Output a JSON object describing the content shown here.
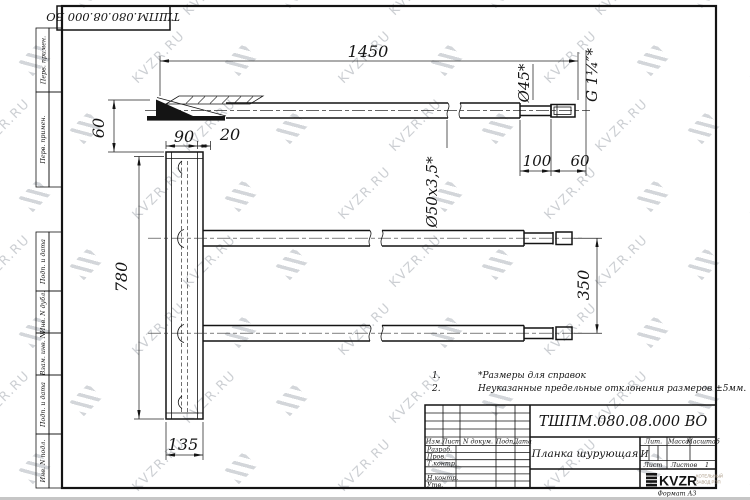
{
  "watermark": {
    "text": "KVZR.RU"
  },
  "top_stamp": {
    "doc_number": "ТШПМ.080.08.000 ВО"
  },
  "margin_labels": [
    "Перв. примен.",
    "Перв. примен.",
    "Подп. и дата",
    "Инв. N дубл.",
    "Взам. инв. N",
    "Подп. и дата",
    "Инв. N подл."
  ],
  "dimensions": {
    "total_length": "1450",
    "left_offset": "60",
    "plate_width": "90",
    "plate_lip": "20",
    "plate_length": "780",
    "tube_spacing": "350",
    "plate_bottom": "135",
    "end_length": "100",
    "thread_length": "60",
    "end_diameter": "Ø45*",
    "tube_section": "Ø50x3,5*",
    "thread": "G 1¼″*"
  },
  "notes": [
    {
      "num": "1.",
      "text": "*Размеры для справок"
    },
    {
      "num": "2.",
      "text": "Неуказанные предельные отклонения размеров ±5мм."
    }
  ],
  "title_block": {
    "doc_number": "ТШПМ.080.08.000 ВО",
    "part_name": "Планка шурующая",
    "header_cells": [
      "Изм.",
      "Лист",
      "N докум.",
      "Подп.",
      "Дата"
    ],
    "signature_rows": [
      "Разраб.",
      "Пров.",
      "Т.контр.",
      "",
      "Н.контр.",
      "Утв."
    ],
    "lit_label": "Лит.",
    "mass_label": "Масса",
    "scale_label": "Масштаб",
    "lit_value": "И",
    "sheet_label": "Лист",
    "sheets_label": "Листов",
    "sheets_value": "1",
    "company": "KVZR",
    "company_sub1": "КОТЕЛЬНЫЙ",
    "company_sub2": "ЗАВОД РЭП",
    "format": "Формат А3"
  }
}
